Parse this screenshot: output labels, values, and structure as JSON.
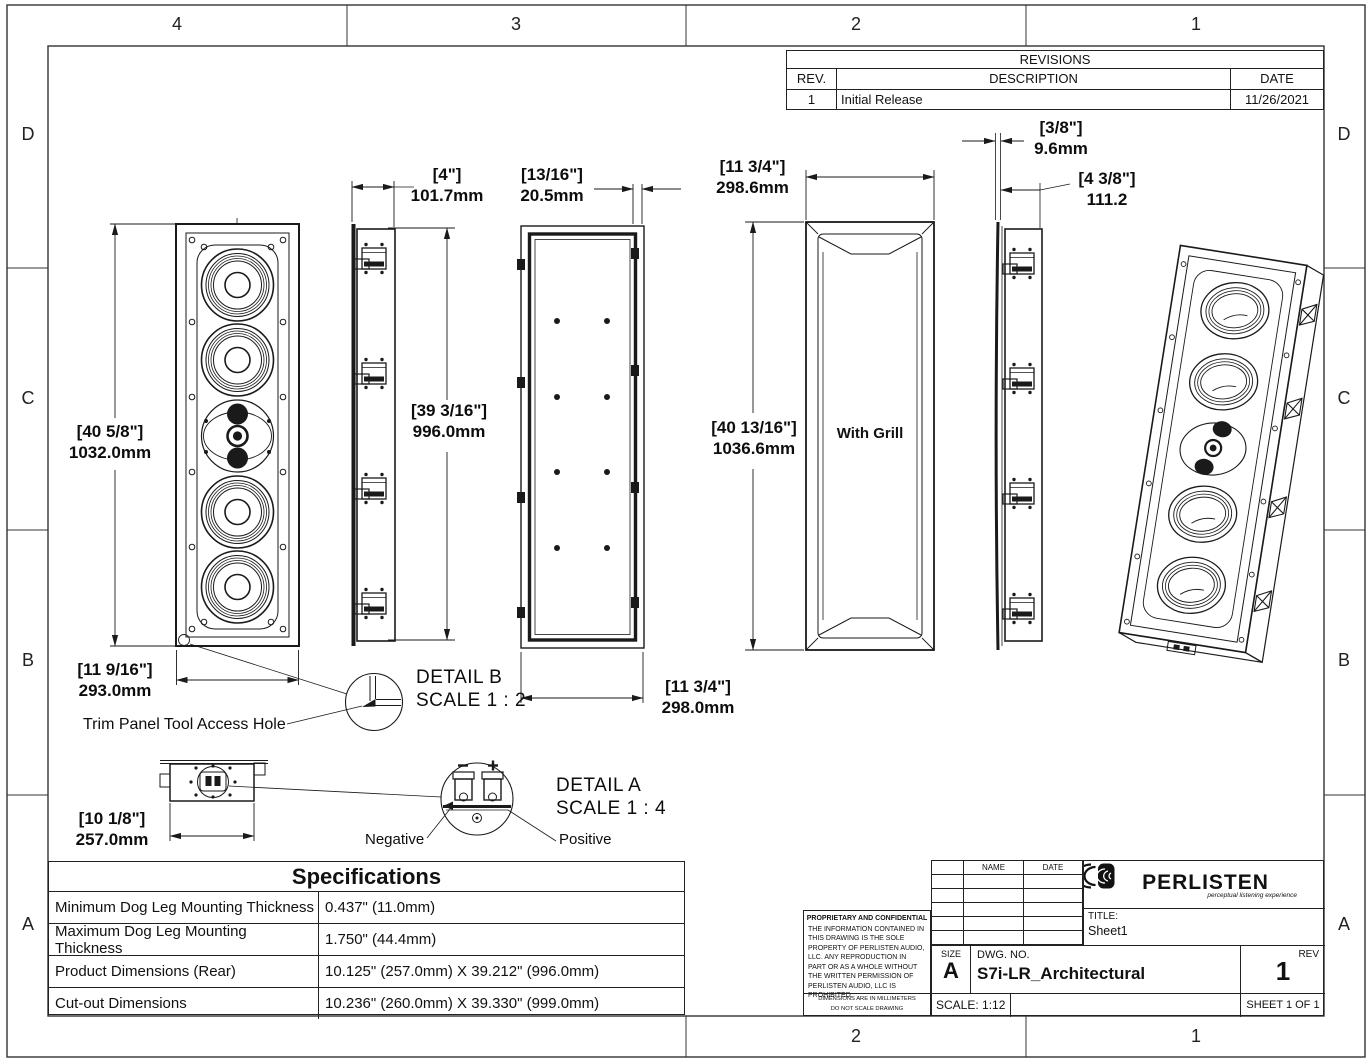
{
  "sheet": {
    "zones_top": [
      "4",
      "3",
      "2",
      "1"
    ],
    "zones_bottom": [
      "2",
      "1"
    ],
    "zones_left": [
      "D",
      "C",
      "B",
      "A"
    ],
    "zones_right": [
      "D",
      "C",
      "B",
      "A"
    ]
  },
  "revisions": {
    "title": "REVISIONS",
    "headers": {
      "rev": "REV.",
      "description": "DESCRIPTION",
      "date": "DATE"
    },
    "rows": [
      {
        "rev": "1",
        "description": "Initial Release",
        "date": "11/26/2021"
      }
    ]
  },
  "dims": {
    "front_height": {
      "in": "[40 5/8\"]",
      "mm": "1032.0mm"
    },
    "front_width": {
      "in": "[11 9/16\"]",
      "mm": "293.0mm"
    },
    "side_depth": {
      "in": "[4\"]",
      "mm": "101.7mm"
    },
    "side_height": {
      "in": "[39 3/16\"]",
      "mm": "996.0mm"
    },
    "wall_thickness": {
      "in": "[13/16\"]",
      "mm": "20.5mm"
    },
    "grill_width_top": {
      "in": "[11 3/4\"]",
      "mm": "298.6mm"
    },
    "grill_height": {
      "in": "[40 13/16\"]",
      "mm": "1036.6mm"
    },
    "grill_thickness": {
      "in": "[3/8\"]",
      "mm": "9.6mm"
    },
    "depth_with_grill": {
      "in": "[4 3/8\"]",
      "mm": "111.2"
    },
    "rear_width": {
      "in": "[11 3/4\"]",
      "mm": "298.0mm"
    },
    "bottom_width": {
      "in": "[10 1/8\"]",
      "mm": "257.0mm"
    }
  },
  "labels": {
    "with_grill": "With Grill",
    "detail_b_title": "DETAIL B",
    "detail_b_scale": "SCALE 1 : 2",
    "detail_a_title": "DETAIL A",
    "detail_a_scale": "SCALE 1 : 4",
    "trim_note": "Trim Panel Tool Access Hole",
    "negative": "Negative",
    "positive": "Positive"
  },
  "specifications": {
    "title": "Specifications",
    "rows": [
      {
        "name": "Minimum Dog Leg Mounting Thickness",
        "value": "0.437\" (11.0mm)"
      },
      {
        "name": "Maximum Dog Leg Mounting Thickness",
        "value": "1.750\" (44.4mm)"
      },
      {
        "name": "Product Dimensions (Rear)",
        "value": "10.125\" (257.0mm) X 39.212\" (996.0mm)"
      },
      {
        "name": "Cut-out Dimensions",
        "value": "10.236\" (260.0mm) X 39.330\" (999.0mm)"
      }
    ]
  },
  "title_block": {
    "name_header": "NAME",
    "date_header": "DATE",
    "brand": "PERLISTEN",
    "tagline": "perceptual listening experience",
    "title_label": "TITLE:",
    "title_value": "Sheet1",
    "size_label": "SIZE",
    "size_value": "A",
    "dwg_label": "DWG. NO.",
    "dwg_value": "S7i-LR_Architectural",
    "rev_label": "REV",
    "rev_value": "1",
    "scale_label": "SCALE: 1:12",
    "sheet_label": "SHEET 1 OF 1",
    "proprietary_title": "PROPRIETARY AND CONFIDENTIAL",
    "proprietary_body": "THE INFORMATION CONTAINED IN THIS DRAWING IS THE SOLE PROPERTY OF PERLISTEN AUDIO, LLC.  ANY REPRODUCTION IN PART OR AS A WHOLE WITHOUT THE WRITTEN PERMISSION OF PERLISTEN AUDIO, LLC IS PROHIBITED.",
    "note_units": "DIMENSIONS ARE IN MILLIMETERS",
    "note_scale": "DO NOT SCALE DRAWING"
  }
}
